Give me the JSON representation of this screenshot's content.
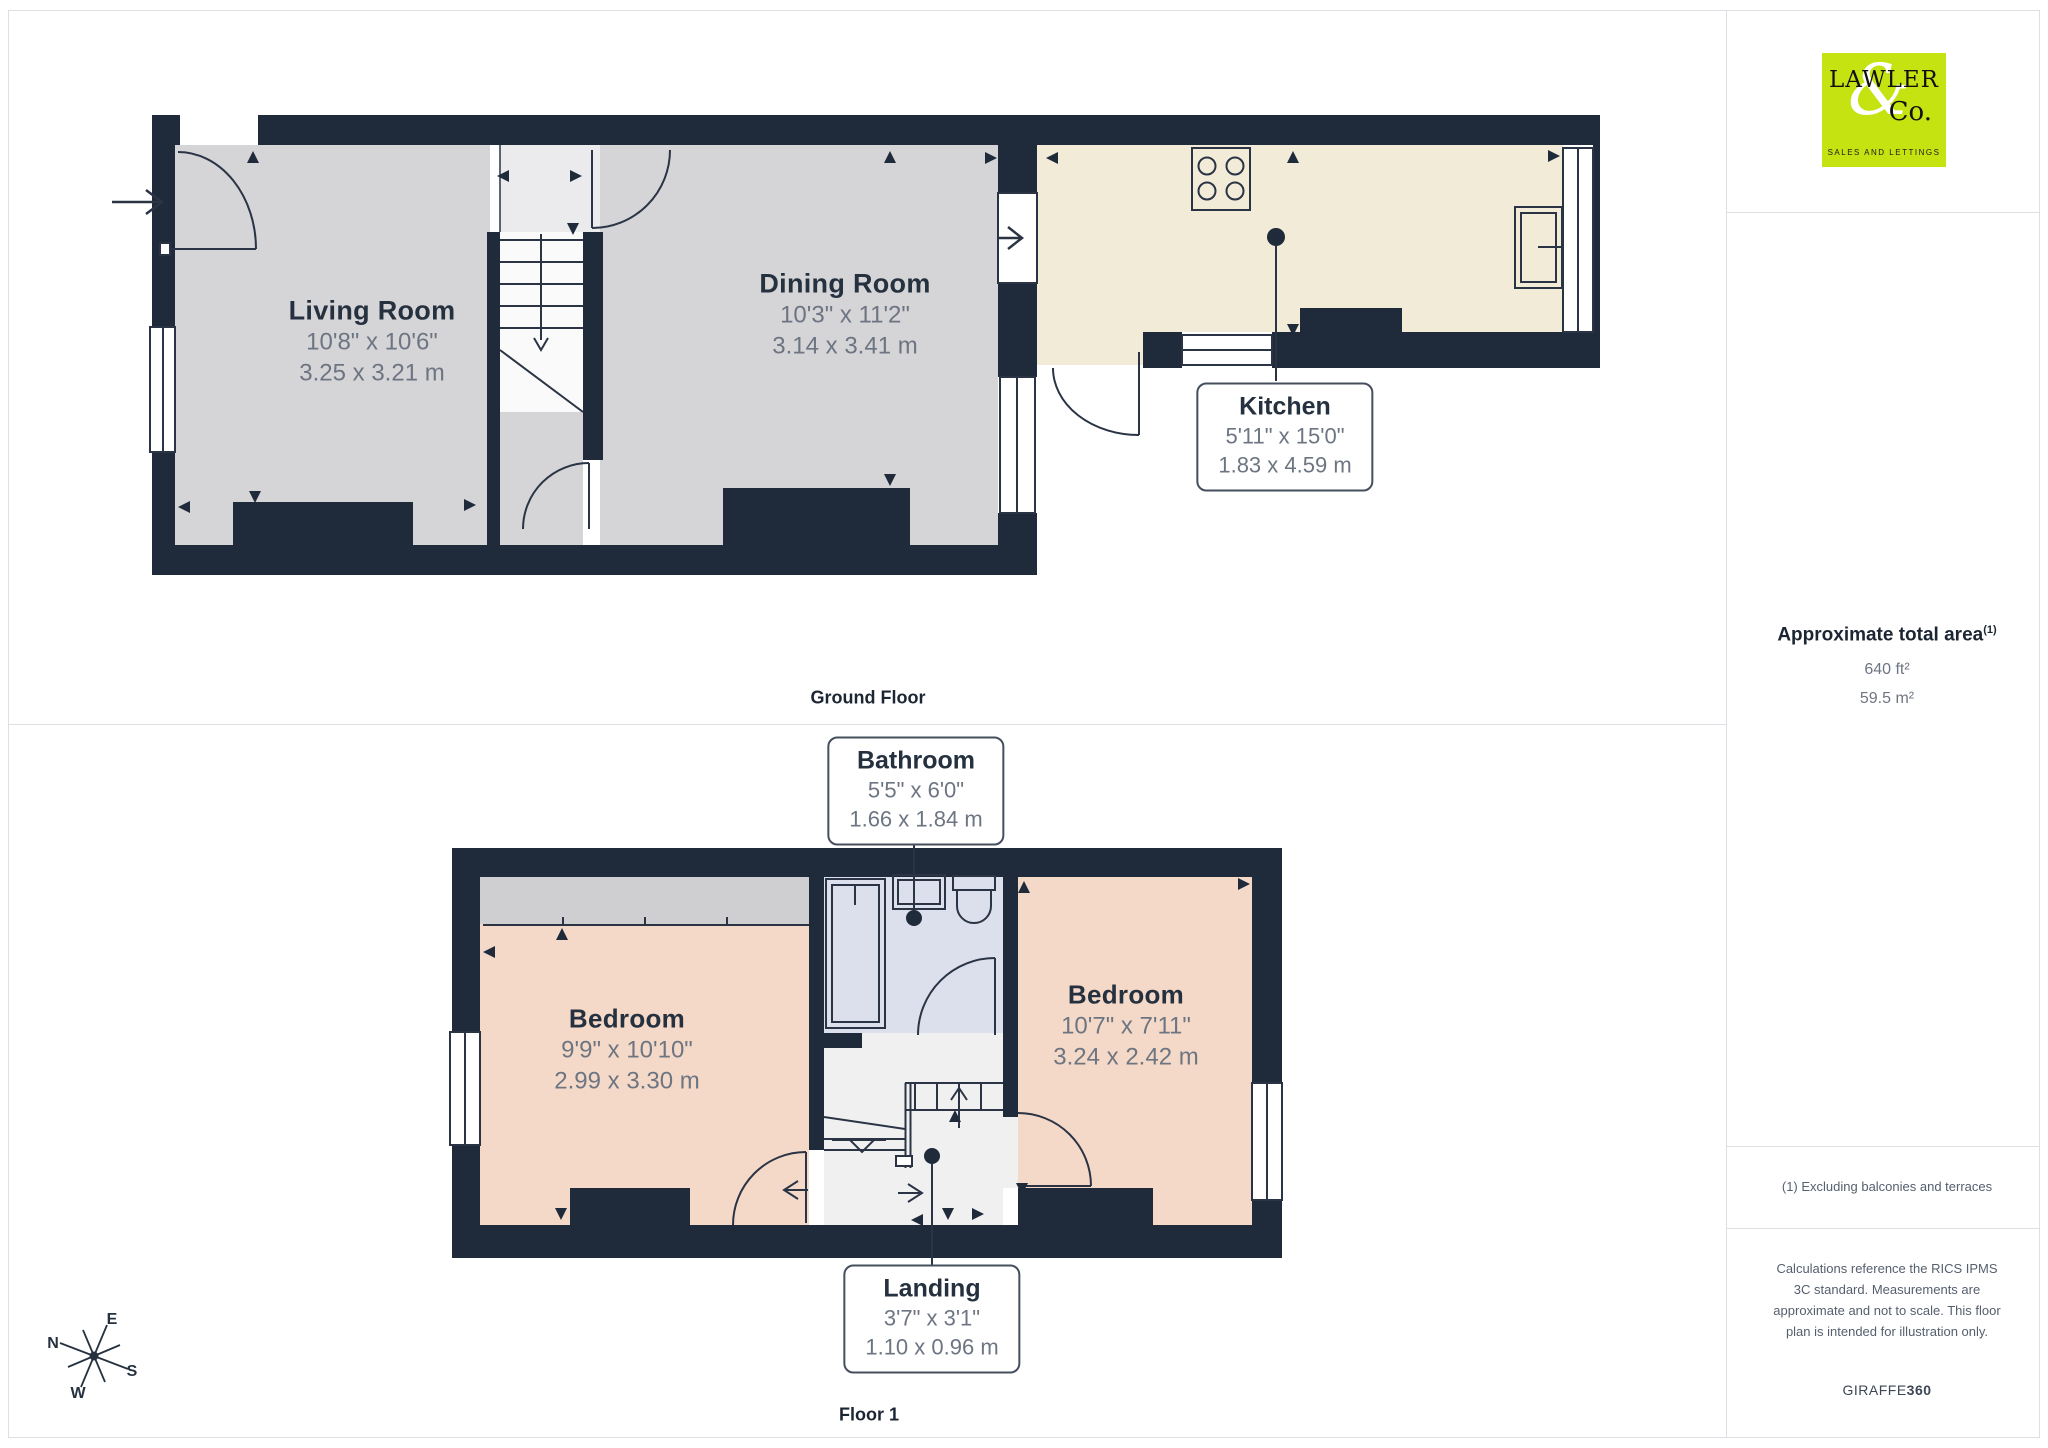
{
  "floors": {
    "ground": {
      "label": "Ground Floor",
      "rooms": {
        "living": {
          "name": "Living Room",
          "imperial": "10'8\" x 10'6\"",
          "metric": "3.25 x 3.21 m"
        },
        "dining": {
          "name": "Dining Room",
          "imperial": "10'3\" x 11'2\"",
          "metric": "3.14 x 3.41 m"
        },
        "kitchen": {
          "name": "Kitchen",
          "imperial": "5'11\" x 15'0\"",
          "metric": "1.83 x 4.59 m"
        }
      }
    },
    "first": {
      "label": "Floor 1",
      "rooms": {
        "bathroom": {
          "name": "Bathroom",
          "imperial": "5'5\" x 6'0\"",
          "metric": "1.66 x 1.84 m"
        },
        "bedroom1": {
          "name": "Bedroom",
          "imperial": "9'9\" x 10'10\"",
          "metric": "2.99 x 3.30 m"
        },
        "bedroom2": {
          "name": "Bedroom",
          "imperial": "10'7\" x 7'11\"",
          "metric": "3.24 x 2.42 m"
        },
        "landing": {
          "name": "Landing",
          "imperial": "3'7\" x 3'1\"",
          "metric": "1.10 x 0.96 m"
        }
      }
    }
  },
  "sidebar": {
    "logo": {
      "word1": "LAWLER",
      "amp": "&",
      "word2": "Co.",
      "tagline": "SALES AND LETTINGS",
      "bg": "#c5e311"
    },
    "area": {
      "title": "Approximate total area",
      "sup": "(1)",
      "imperial": "640 ft²",
      "metric": "59.5 m²"
    },
    "footnote": "(1) Excluding balconies and terraces",
    "disclaimer": "Calculations reference the RICS IPMS 3C standard. Measurements are approximate and not to scale. This floor plan is intended for illustration only.",
    "brand": {
      "name": "GIRAFFE",
      "suffix": "360"
    }
  },
  "compass": {
    "n": "N",
    "e": "E",
    "s": "S",
    "w": "W"
  },
  "colors": {
    "wall": "#1f2a3a",
    "room_gray": "#d5d4d7",
    "hall_light": "#ebebed",
    "kitchen_cream": "#f1ebd8",
    "bedroom_salmon": "#f5d9c8",
    "wardrobe_gray": "#cfcfd2",
    "bathroom_blue": "#dbe0ec",
    "landing_white": "#f0f0f1",
    "logo_green": "#c5e311",
    "label_navy": "#263140",
    "dim_gray": "#6d7582"
  }
}
